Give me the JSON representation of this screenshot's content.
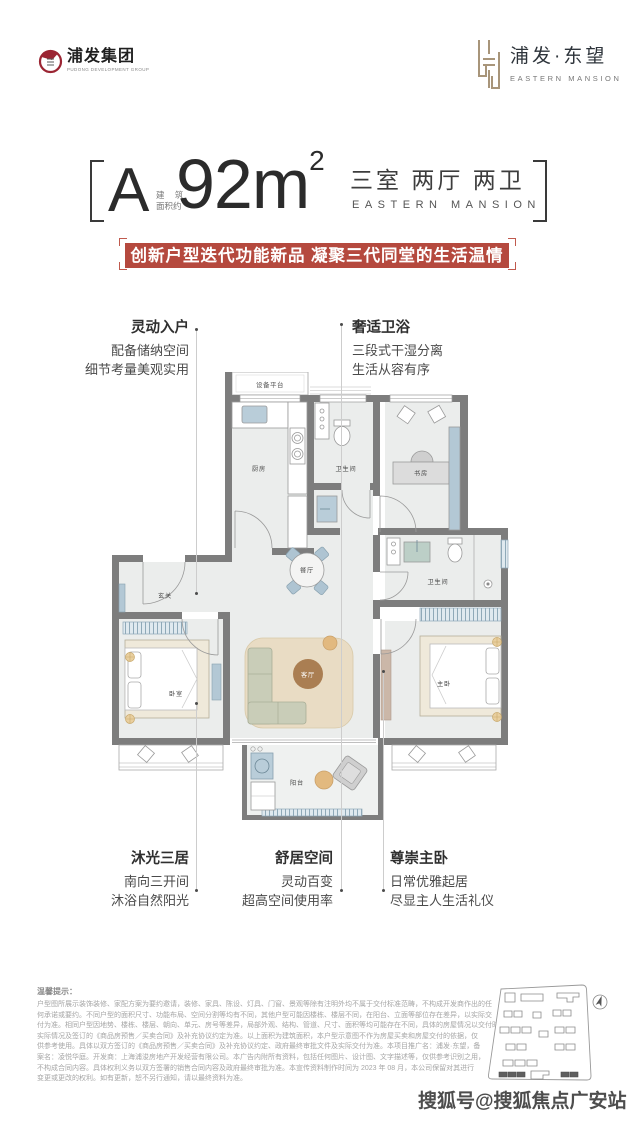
{
  "header": {
    "group_logo": {
      "name": "浦发集团",
      "subtitle": "PUDONG DEVELOPMENT GROUP",
      "emblem_color": "#9b2533"
    },
    "brand_logo": {
      "name": "浦发·东望",
      "subtitle": "EASTERN MANSION",
      "emblem_color": "#a8957a"
    }
  },
  "title": {
    "unit": "A",
    "area_prefix_line1": "建 筑",
    "area_prefix_line2": "面积约",
    "area_value": "92m",
    "area_sup": "2",
    "rooms": "三室 两厅 两卫",
    "rooms_en": "EASTERN MANSION"
  },
  "banner": {
    "text": "创新户型迭代功能新品 凝聚三代同堂的生活温情",
    "bg": "#b5493e"
  },
  "callouts": {
    "top_left": {
      "title": "灵动入户",
      "lines": [
        "配备储纳空间",
        "细节考量美观实用"
      ]
    },
    "top_right": {
      "title": "奢适卫浴",
      "lines": [
        "三段式干湿分离",
        "生活从容有序"
      ]
    },
    "bottom_left": {
      "title": "沐光三居",
      "lines": [
        "南向三开间",
        "沐浴自然阳光"
      ]
    },
    "bottom_center": {
      "title": "舒居空间",
      "lines": [
        "灵动百变",
        "超高空间使用率"
      ]
    },
    "bottom_right": {
      "title": "尊崇主卧",
      "lines": [
        "日常优雅起居",
        "尽显主人生活礼仪"
      ]
    }
  },
  "floorplan": {
    "wall_color": "#7d7d7d",
    "floor_color": "#ebedec",
    "rooms": {
      "equipment": "设备平台",
      "kitchen": "厨房",
      "bath1": "卫生间",
      "study": "书房",
      "dining": "餐厅",
      "foyer": "玄关",
      "bath2": "卫生间",
      "bedroom": "卧室",
      "living": "客厅",
      "master": "主卧",
      "balcony": "阳台"
    }
  },
  "disclaimer": {
    "title": "温馨提示：",
    "lines": [
      "户型图所展示装饰装修、家配方案为要约邀请，装修、家具、陈设、灯具、门窗、景观等除有注明外均不属于交付标准范畴，不构成开发商作出的任",
      "何承诺或要约。不同户型的面积尺寸、功能布局、空间分割等均有不同，其他户型可能因楼栋、楼层不同，在阳台、立面等部位存在差异，以实际交",
      "付为准。相同户型因地势、楼栋、楼层、朝向、单元、房号等差异，局部外观、结构、管道、尺寸、面积等均可能存在不同，具体的房屋情况以交付时",
      "实际情况及签订的《商品房预售／买卖合同》及补充协议约定为准。以上面积为建筑面积，本户型示意图不作为房屋买卖和房屋交付的依据，仅",
      "供参考使用。具体以双方签订的《商品房预售／买卖合同》及补充协议约定、政府最终审批文件及实际交付为准。本项目推广名：浦发·东望，备",
      "案名：凌悦华庭。开发商：上海浦浚房地产开发经营有限公司。本广告内附所有资料，包括任何图片、设计图、文字描述等，仅供参考识别之用，",
      "不构成合同内容。具体权利义务以双方签署的销售合同内容及政府最终审批为准。本宣传资料制作时间为 2023 年 08 月，本公司保留对其进行",
      "变更或更改的权利。如有更新，恕不另行通知，请以最终资料为准。"
    ]
  },
  "watermark": "搜狐号@搜狐焦点广安站"
}
